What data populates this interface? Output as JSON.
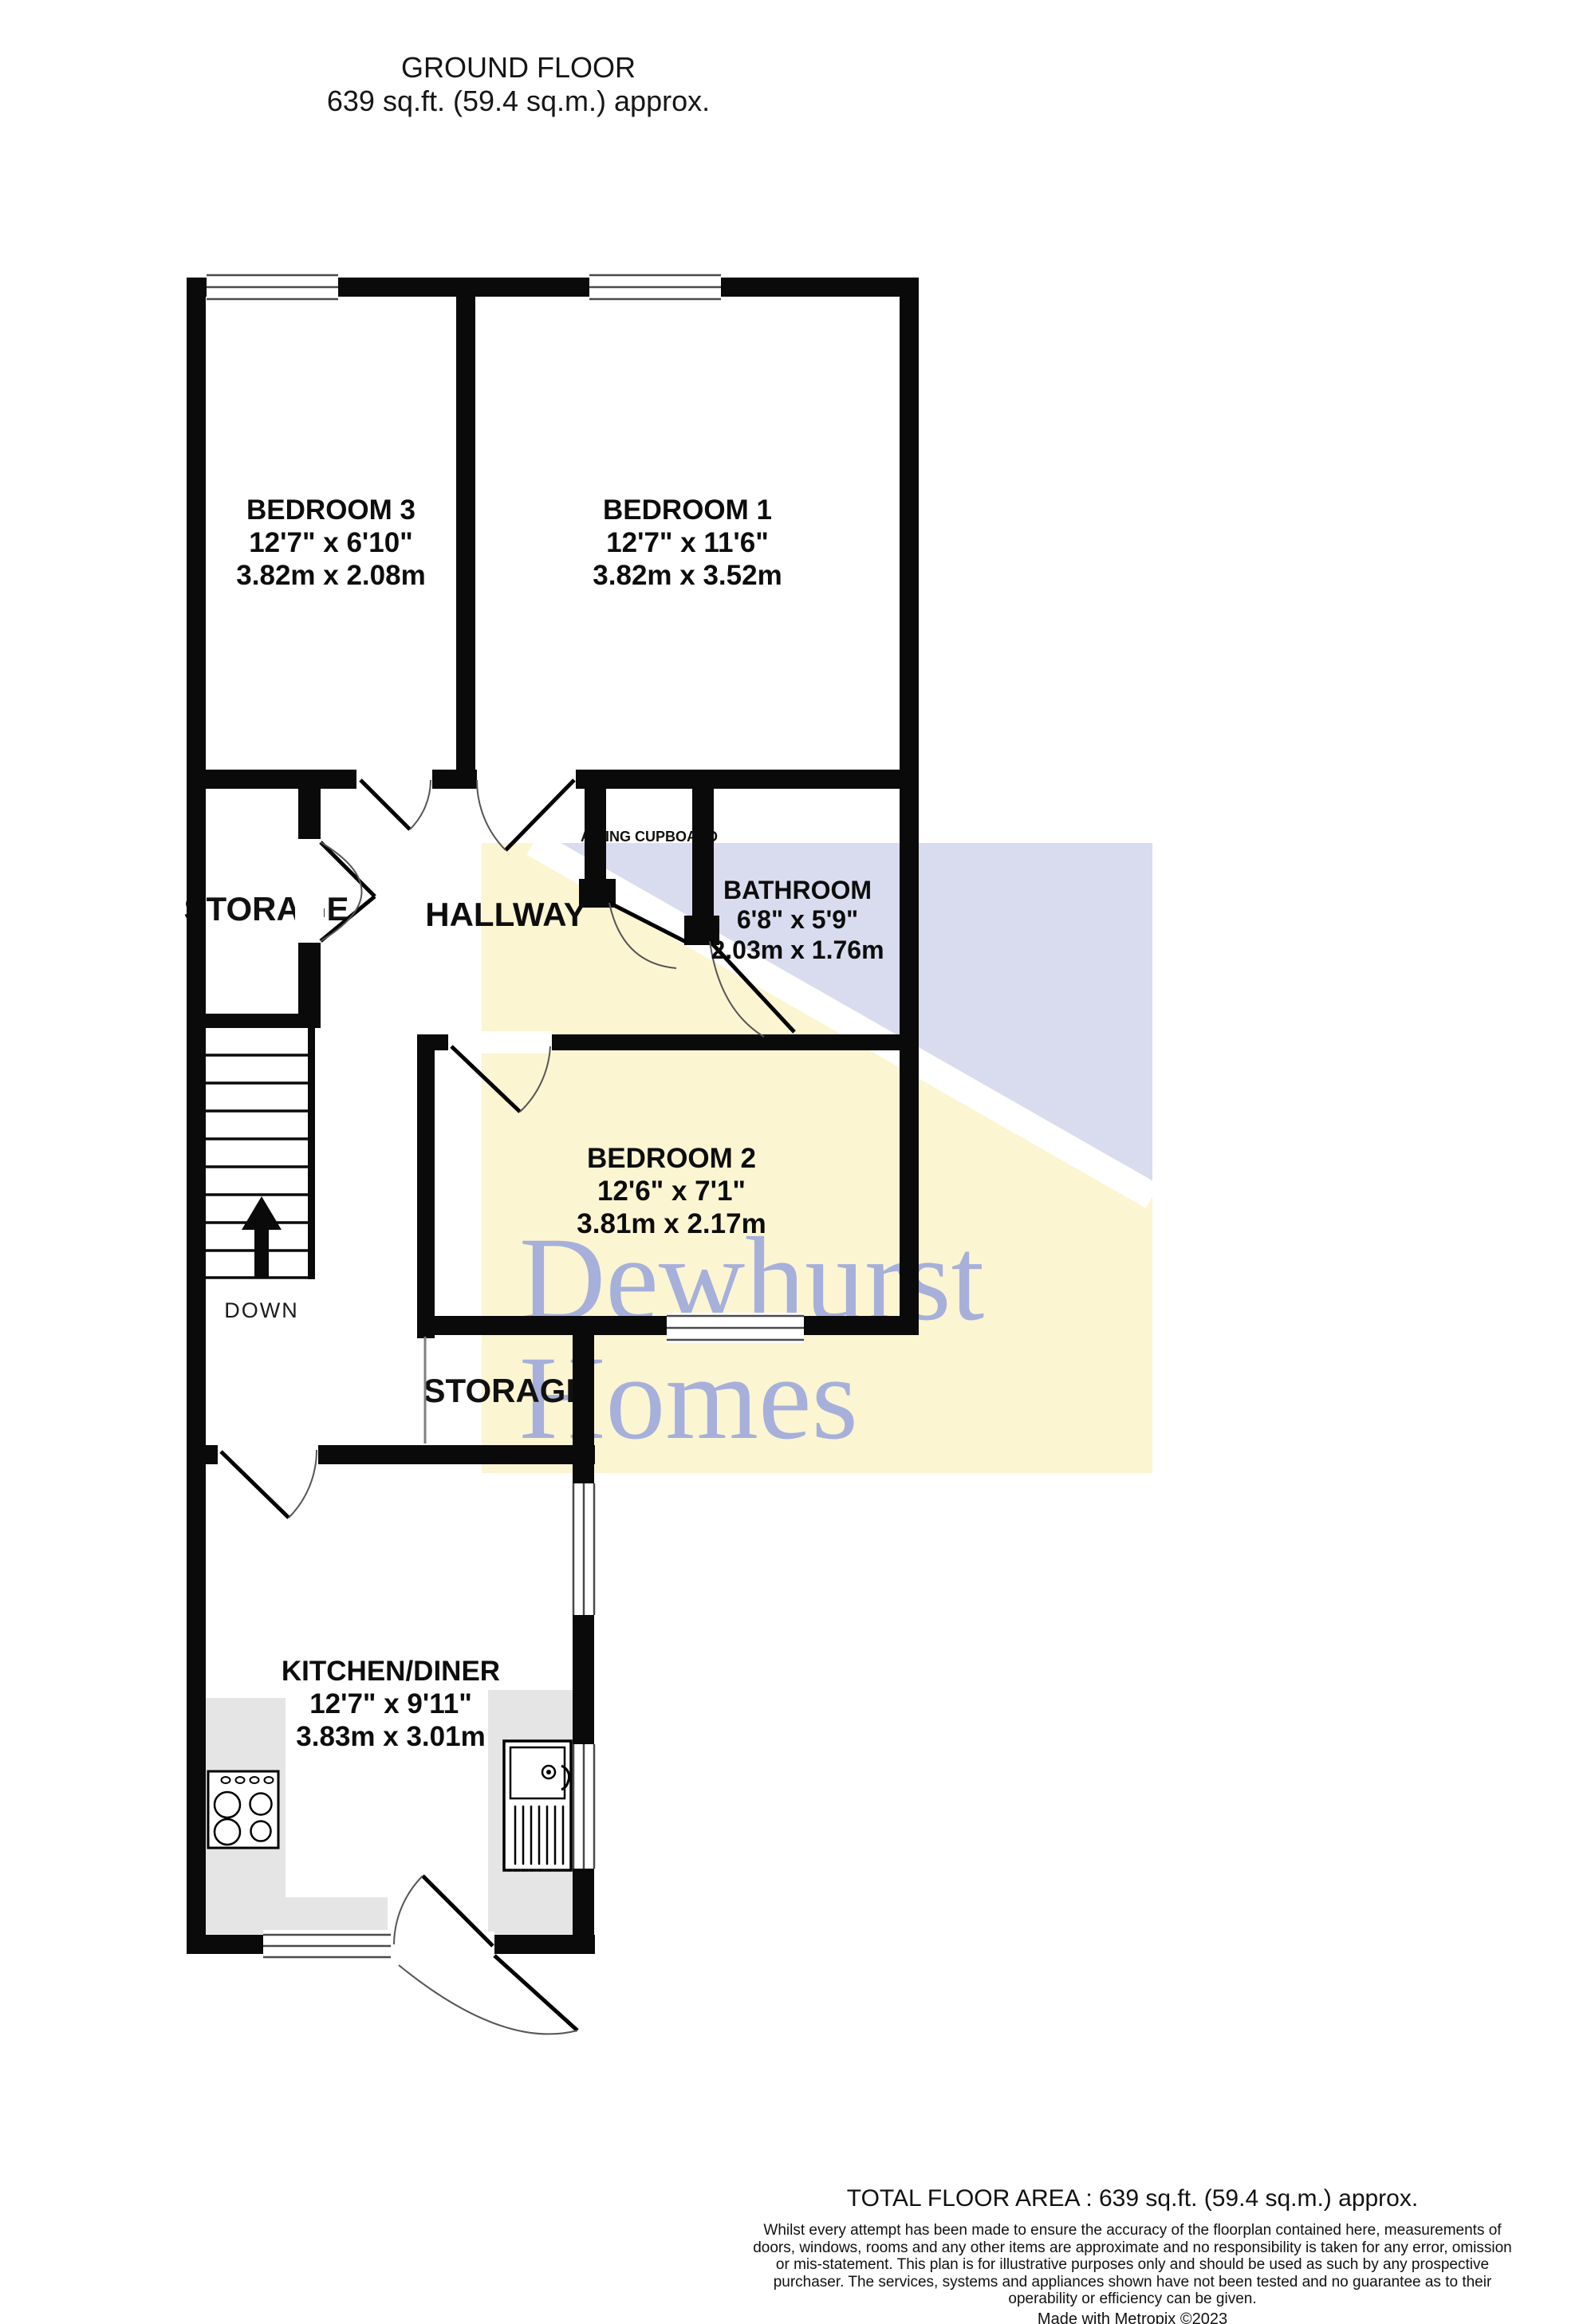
{
  "header": {
    "title": "GROUND FLOOR",
    "subtitle": "639 sq.ft. (59.4 sq.m.) approx."
  },
  "rooms": {
    "bedroom3": {
      "name": "BEDROOM 3",
      "imperial": "12'7\"  x 6'10\"",
      "metric": "3.82m  x 2.08m"
    },
    "bedroom1": {
      "name": "BEDROOM 1",
      "imperial": "12'7\"  x 11'6\"",
      "metric": "3.82m  x 3.52m"
    },
    "bedroom2": {
      "name": "BEDROOM 2",
      "imperial": "12'6\"  x 7'1\"",
      "metric": "3.81m  x 2.17m"
    },
    "bathroom": {
      "name": "BATHROOM",
      "imperial": "6'8\"  x 5'9\"",
      "metric": "2.03m  x 1.76m"
    },
    "kitchen": {
      "name": "KITCHEN/DINER",
      "imperial": "12'7\"  x 9'11\"",
      "metric": "3.83m  x 3.01m"
    },
    "hallway": {
      "name": "HALLWAY"
    },
    "storage_upper": {
      "name": "STORAGE"
    },
    "storage_lower": {
      "name": "STORAGE"
    },
    "airing_cupboard": {
      "name": "AIRING CUPBOARD"
    },
    "stairs": {
      "label": "DOWN"
    }
  },
  "watermark": {
    "line1": "Dewhurst",
    "line2": "Homes"
  },
  "footer": {
    "total_area": "TOTAL FLOOR AREA : 639 sq.ft. (59.4 sq.m.) approx.",
    "disclaimer": "Whilst every attempt has been made to ensure the accuracy of the floorplan contained here, measurements of doors, windows, rooms and any other items are approximate and no responsibility is taken for any error, omission or mis-statement. This plan is for illustrative purposes only and should be used as such by any prospective purchaser. The services, systems and appliances shown have not been tested and no guarantee as to their operability or efficiency can be given.",
    "credit": "Made with Metropix ©2023"
  },
  "colors": {
    "wall": "#0a0a0a",
    "watermark_yellow": "#fbf5d2",
    "watermark_lavender": "#d9dcee",
    "watermark_text": "#a6b0da",
    "counter_gray": "#e5e5e5"
  }
}
